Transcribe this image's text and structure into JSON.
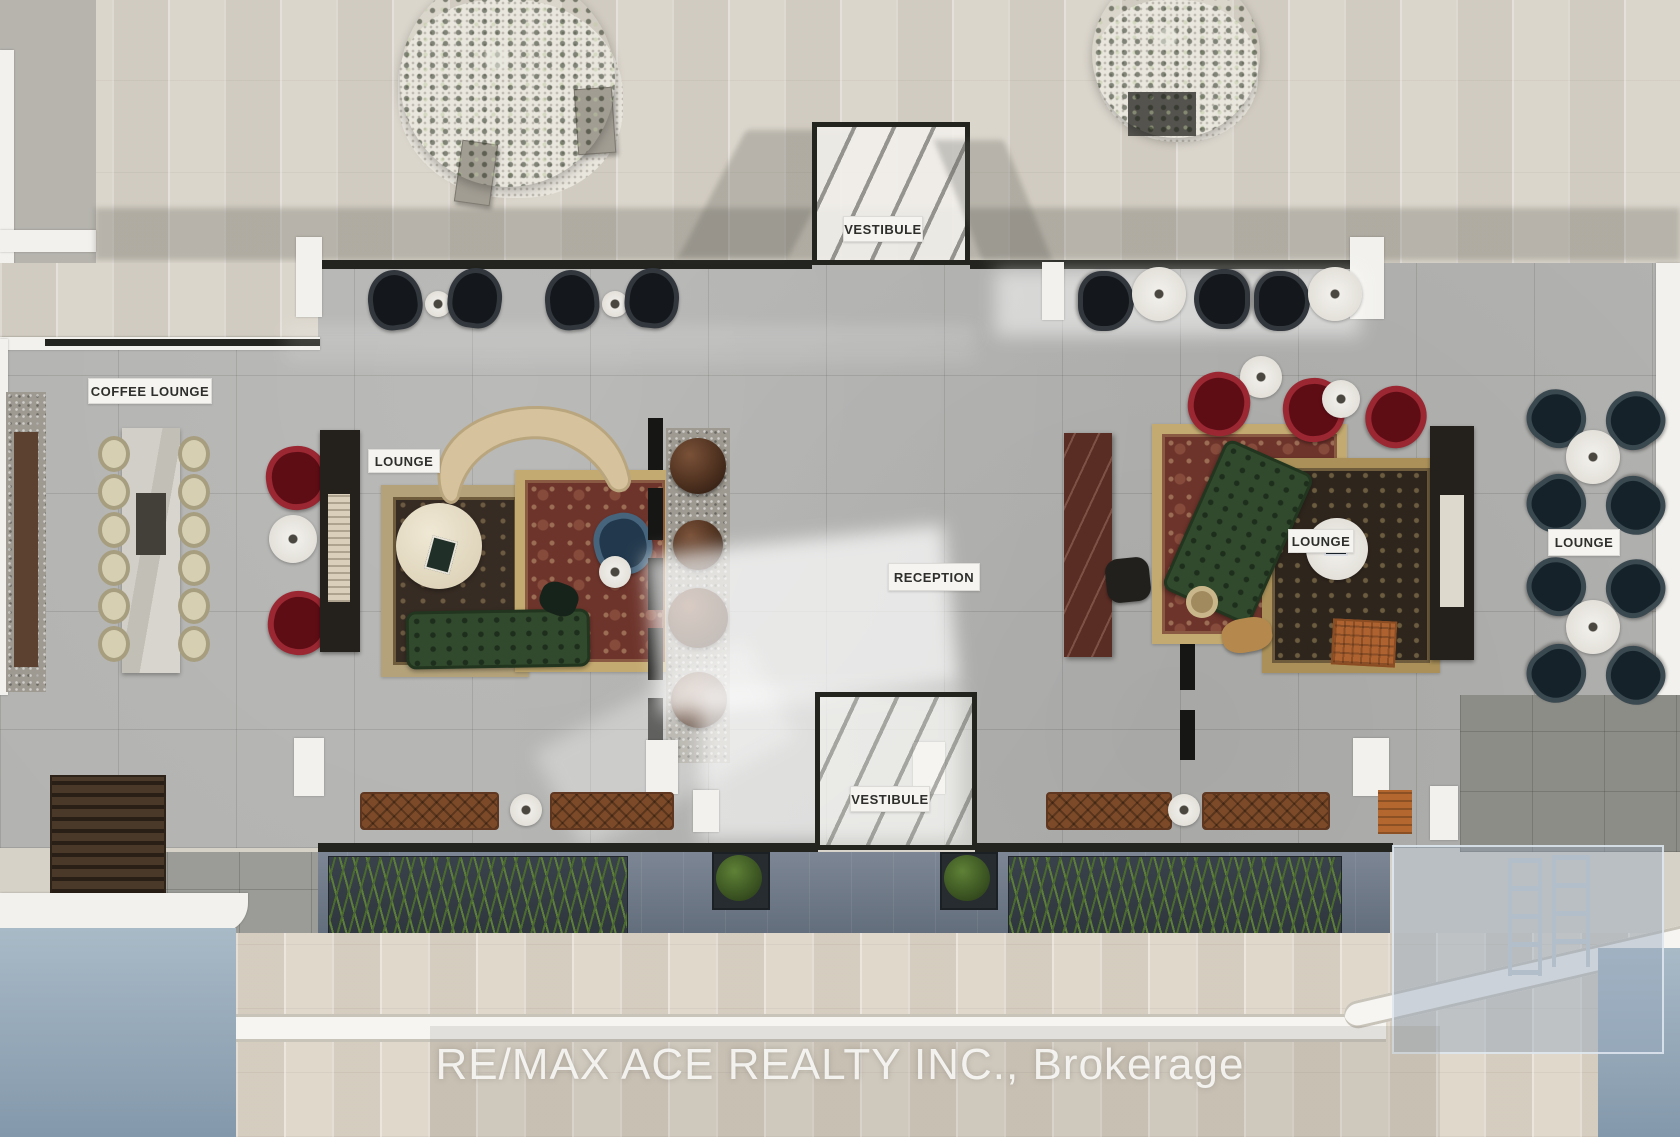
{
  "labels": {
    "vestibule_top": "VESTIBULE",
    "coffee_lounge": "COFFEE LOUNGE",
    "lounge_left": "LOUNGE",
    "reception": "RECEPTION",
    "lounge_right": "LOUNGE",
    "lounge_far_right": "LOUNGE",
    "vestibule_bottom": "VESTIBULE"
  },
  "watermark": "RE/MAX ACE REALTY INC., Brokerage",
  "colors": {
    "terrace_paver": "#d7d2c8",
    "lobby_floor": "#b2b2b0",
    "label_bg": "#f5f4f0",
    "label_text": "#2e2e2c",
    "accent_red_chair": "#9b2732",
    "sofa_green": "#31492c",
    "rug_red_field": "#6d342b",
    "rug_border_beige": "#c3aa70",
    "reception_marble": "#5a2d24",
    "water_blue": "#8fa5b6",
    "plant_green": "#5d7e3b",
    "bench_brown": "#7c4a28",
    "watermark_text_color": "rgba(253,253,251,0.85)"
  }
}
